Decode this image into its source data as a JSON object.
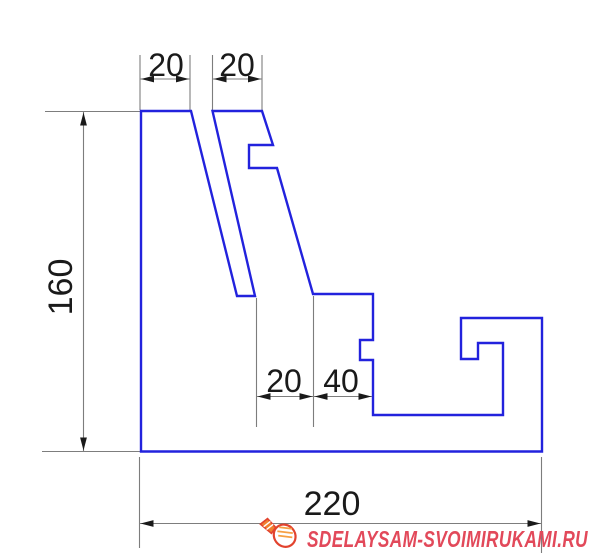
{
  "drawing": {
    "type": "dimensioned-profile-cross-section",
    "outline_color": "#2222dd",
    "dimension_line_color": "#7d7d7d",
    "dimension_text_color": "#1a1a1a",
    "background_color": "#ffffff",
    "dimensions": {
      "top_left_width": "20",
      "top_right_width": "20",
      "height": "160",
      "mid_left_width": "20",
      "mid_right_width": "40",
      "base_width": "220"
    }
  },
  "watermark": {
    "text": "SDELAYSAM-SVOIMIRUKAMI.RU",
    "color": "#e2495a",
    "icon": "lightbulb-icon"
  }
}
